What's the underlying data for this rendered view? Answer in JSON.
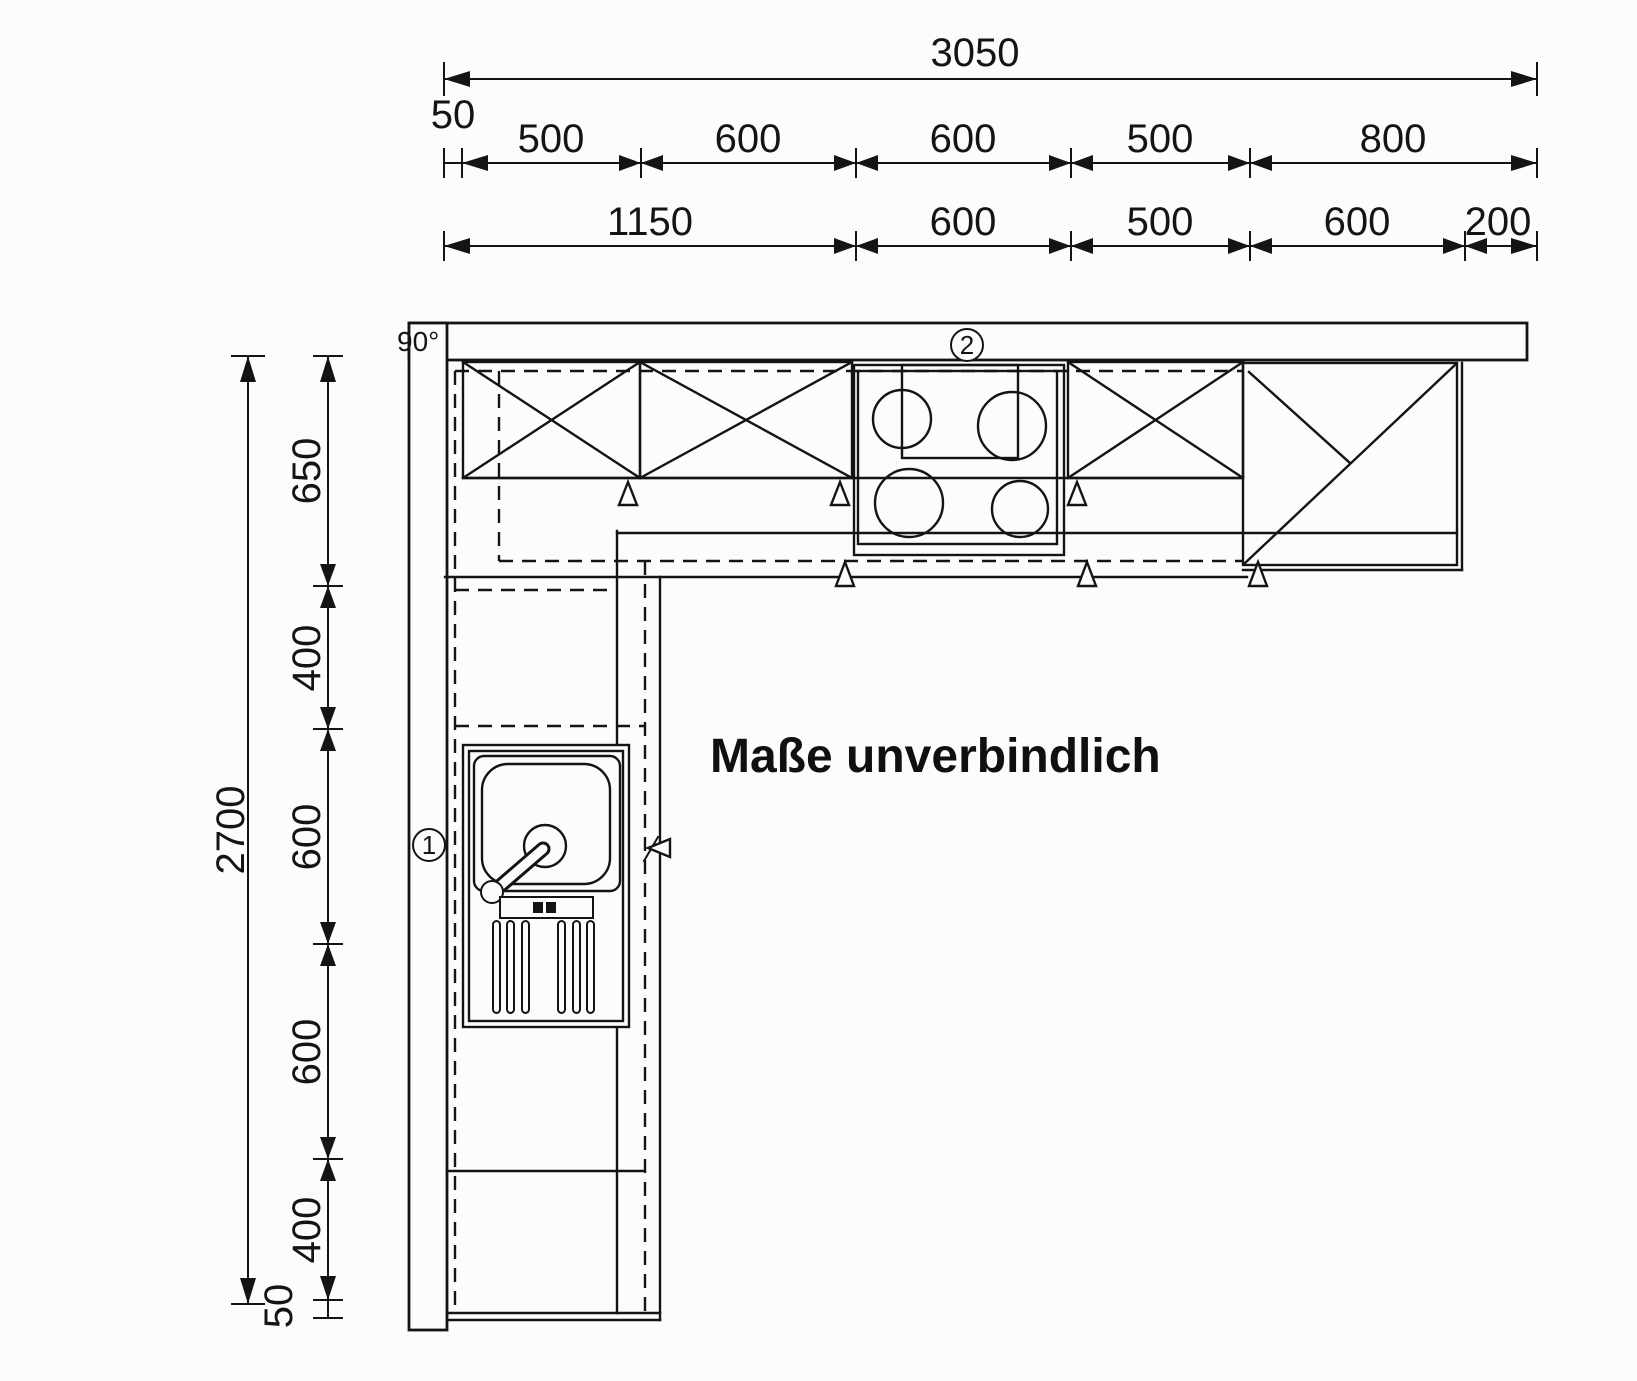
{
  "drawing": {
    "note": "Maße unverbindlich",
    "corner_angle": "90°",
    "marker_1": "1",
    "marker_2": "2"
  },
  "dimensions_top": {
    "total": "3050",
    "wall_offset": "50",
    "upper_row": [
      "500",
      "600",
      "600",
      "500",
      "800"
    ],
    "lower_row": [
      "1150",
      "600",
      "500",
      "600",
      "200"
    ]
  },
  "dimensions_left": {
    "total": "2700",
    "segments": [
      "650",
      "400",
      "600",
      "600",
      "400",
      "50"
    ]
  }
}
